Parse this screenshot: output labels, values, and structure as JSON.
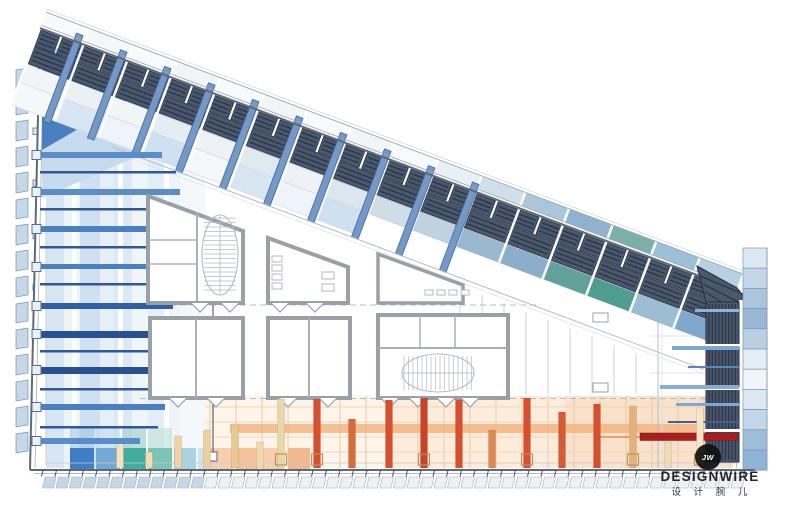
{
  "watermark": {
    "monogram": "JW",
    "brand": "DESIGNWIRE",
    "brand_cn": "设 计 腕 儿"
  },
  "palette": {
    "background": "#ffffff",
    "outline": "#5f6a78",
    "outline_soft": "#9aa5b0",
    "louver_fill": "#4a586e",
    "louver_stripe": "#2c3648",
    "louver_edge": "#263043",
    "strut_fill": "#7499c6",
    "strut_edge": "#41679b",
    "wall_gray": "#9aa0a8",
    "wall_light": "#b4bac2",
    "grid_gray": "#ccd2da",
    "dash_gray": "#b4bcc6",
    "red_bar": "#a81e1e",
    "warm_line": "#ecc9a4",
    "warm_band": "#f2b582",
    "fringe_blue": "#c6d7e8",
    "fringe_gray": "#eef1f4"
  },
  "roof_band": {
    "bay_count": 16,
    "outer_row_colors": [
      "#f7f9fb",
      "#f4f7f9",
      "#f7f9fb",
      "#f2f5f8",
      "#f7f9fb",
      "#f2f5f8",
      "#f7f9fb",
      "#f2f5f8",
      "#f7f9fb",
      "#e8eff5",
      "#cfdfec",
      "#aac6dc",
      "#8fb3cf",
      "#79b0a8",
      "#9dc0d8",
      "#b7d0e4"
    ],
    "inner_row_colors": [
      "#f2f5f8",
      "#eaf0f4",
      "#f2f5f8",
      "#e6edf2",
      "#eef2f6",
      "#e0e9f0",
      "#eef2f6",
      "#dce6ee",
      "#d0dde8",
      "#c0d2e0",
      "#9ab8d0",
      "#8aaecb",
      "#63a29a",
      "#4f9d8f",
      "#9dbdd4",
      "#7fa8cc"
    ],
    "sub_row_colors": [
      "#f4f8fb",
      "#d8e6f3",
      "#eef4f9",
      "#cfe0f0",
      "#f4f8fb",
      "#d8e6f3",
      "#eef4f9",
      "#cfe0f0"
    ],
    "strut_positions": [
      36,
      83,
      130,
      177,
      224,
      271,
      318,
      365,
      412,
      459
    ]
  },
  "left_facade": {
    "stripes": [
      [
        46,
        18,
        "#d8e6f3"
      ],
      [
        64,
        16,
        "#ecf3f9"
      ],
      [
        80,
        20,
        "#cfe0f0"
      ],
      [
        100,
        14,
        "#e6eff7"
      ],
      [
        114,
        18,
        "#dce9f4"
      ],
      [
        132,
        16,
        "#f0f5fa"
      ],
      [
        148,
        18,
        "#e4eef7"
      ],
      [
        166,
        14,
        "#eef4fa"
      ],
      [
        180,
        25,
        "#f4f8fb"
      ]
    ],
    "triangle_light": "#c6dbee",
    "triangle_dark": "#4a7fc0",
    "bars": [
      [
        152,
        122,
        6,
        "#5b8ec9"
      ],
      [
        171,
        136,
        2.5,
        "#31588f"
      ],
      [
        189,
        140,
        6,
        "#5b8ec9"
      ],
      [
        208,
        118,
        2.5,
        "#31588f"
      ],
      [
        226,
        130,
        6,
        "#4a7fc0"
      ],
      [
        246,
        128,
        2.5,
        "#31588f"
      ],
      [
        264,
        110,
        5,
        "#4a7fc0"
      ],
      [
        283,
        126,
        2.5,
        "#31588f"
      ],
      [
        303,
        133,
        6,
        "#2f5fa8"
      ],
      [
        331,
        143,
        7,
        "#28518f"
      ],
      [
        350,
        120,
        2.5,
        "#31588f"
      ],
      [
        367,
        145,
        7,
        "#28518f"
      ],
      [
        388,
        120,
        2.5,
        "#31588f"
      ],
      [
        404,
        125,
        6,
        "#4a7fc0"
      ],
      [
        426,
        118,
        2.5,
        "#31588f"
      ],
      [
        438,
        100,
        6,
        "#5b8ec9"
      ]
    ],
    "cells_strong": [
      [
        70,
        26,
        "#3f7dc4"
      ],
      [
        96,
        26,
        "#74a8d6"
      ],
      [
        122,
        26,
        "#3fae9d"
      ],
      [
        148,
        26,
        "#7cc4b6"
      ],
      [
        174,
        24,
        "#a9d3e2"
      ],
      [
        198,
        24,
        "#cfe4f0"
      ]
    ],
    "cells_soft": [
      [
        70,
        26,
        "#a9c8e6"
      ],
      [
        96,
        26,
        "#c4dbee"
      ],
      [
        122,
        26,
        "#9fd2c8"
      ],
      [
        148,
        26,
        "#c2e2da"
      ]
    ]
  },
  "right_facade": {
    "panel_colors": [
      "#dce9f4",
      "#c2d7ea",
      "#a9c6de",
      "#98b8d6",
      "#b9d0e4",
      "#e4eef6",
      "#f0f5fa",
      "#dce8f3",
      "#c2d7ea",
      "#9dbdd8",
      "#8fb3d9"
    ],
    "bars": [
      [
        695,
        309,
        3,
        "#8fb3d9"
      ],
      [
        672,
        346,
        4,
        "#7fa7cf"
      ],
      [
        688,
        366,
        2,
        "#5b86bb"
      ],
      [
        660,
        385,
        4,
        "#88aed4"
      ],
      [
        676,
        403,
        3,
        "#7fa7cf"
      ],
      [
        668,
        421,
        2,
        "#44608a"
      ]
    ],
    "red_bar": [
      640,
      433,
      98,
      7.5
    ]
  },
  "bottom_band": {
    "bars": [
      [
        120,
        445,
        "#f4e3bf"
      ],
      [
        149,
        452,
        "#f1dcb3"
      ],
      [
        178,
        436,
        "#eed3a6"
      ],
      [
        207,
        430,
        "#ecd0a0"
      ],
      [
        235,
        424,
        "#e9c992"
      ],
      [
        260,
        442,
        "#f0d9ae"
      ],
      [
        281,
        399,
        "#ead7a9"
      ],
      [
        317,
        399,
        "#d4502e"
      ],
      [
        352,
        419,
        "#db6a3a"
      ],
      [
        389,
        400,
        "#d4502e"
      ],
      [
        424,
        398,
        "#c8432a"
      ],
      [
        459,
        400,
        "#d4502e"
      ],
      [
        492,
        430,
        "#dd8855"
      ],
      [
        527,
        398,
        "#d4502e"
      ],
      [
        562,
        412,
        "#d55c32"
      ],
      [
        597,
        404,
        "#d4502e"
      ],
      [
        633,
        406,
        "#e2b17c"
      ],
      [
        668,
        442,
        "#f0dcb4"
      ],
      [
        700,
        408,
        "#f3e6c8"
      ]
    ],
    "marker_xs": [
      281,
      317,
      424,
      527,
      633,
      700
    ],
    "bg_tints": [
      "#fdf4ea",
      "#fbecdc",
      "#f8e2cc"
    ],
    "warm_cells": [
      [
        210,
        24,
        "#f6cfae"
      ],
      [
        236,
        24,
        "#f3c29a"
      ],
      [
        262,
        24,
        "#f6cfae"
      ],
      [
        288,
        24,
        "#f0b98e"
      ]
    ]
  }
}
